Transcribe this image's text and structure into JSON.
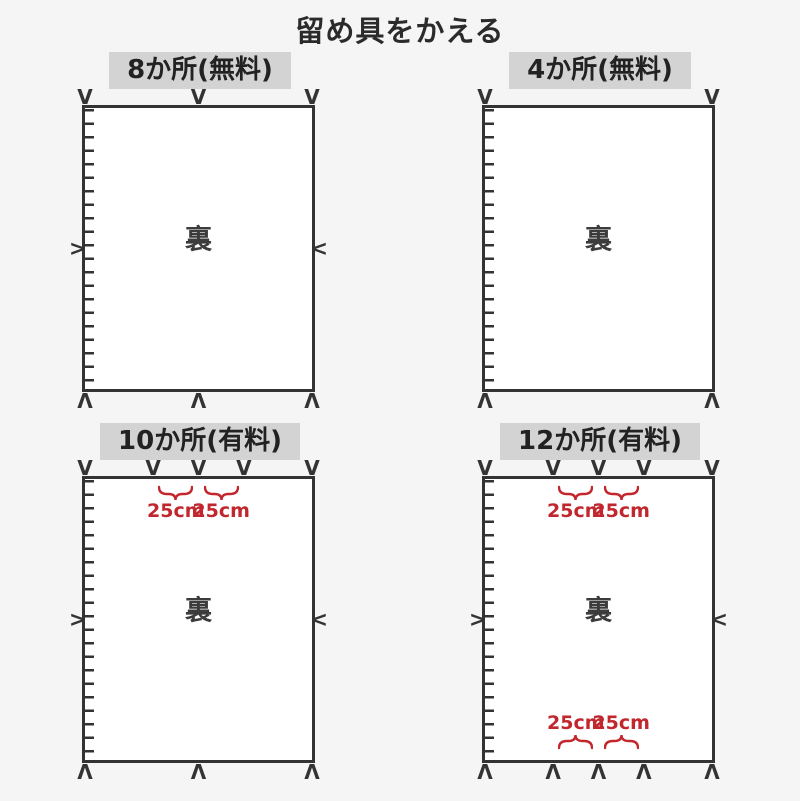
{
  "page": {
    "title": "留め具をかえる",
    "bg": "#f5f5f5"
  },
  "colors": {
    "ink": "#333333",
    "red": "#c1272d",
    "label_bg": "#d3d3d3",
    "rect_bg": "#ffffff"
  },
  "glyphs": {
    "fastener_down": "V",
    "fastener_up": "Λ",
    "fastener_right": ">",
    "fastener_left": "<"
  },
  "panels": [
    {
      "id": "spots-8-free",
      "label": "8か所(無料)",
      "center_label": "裏",
      "top_marks_pct": [
        0,
        50,
        100
      ],
      "bottom_marks_pct": [
        0,
        50,
        100
      ],
      "side_marks": true,
      "annotations": []
    },
    {
      "id": "spots-4-free",
      "label": "4か所(無料)",
      "center_label": "裏",
      "top_marks_pct": [
        0,
        100
      ],
      "bottom_marks_pct": [
        0,
        100
      ],
      "side_marks": false,
      "annotations": []
    },
    {
      "id": "spots-10-paid",
      "label": "10か所(有料)",
      "center_label": "裏",
      "top_marks_pct": [
        0,
        30,
        50,
        70,
        100
      ],
      "bottom_marks_pct": [
        0,
        50,
        100
      ],
      "side_marks": true,
      "annotations": [
        {
          "edge": "top",
          "from_pct": 30,
          "to_pct": 50,
          "label": "25cm"
        },
        {
          "edge": "top",
          "from_pct": 50,
          "to_pct": 70,
          "label": "25cm"
        }
      ]
    },
    {
      "id": "spots-12-paid",
      "label": "12か所(有料)",
      "center_label": "裏",
      "top_marks_pct": [
        0,
        30,
        50,
        70,
        100
      ],
      "bottom_marks_pct": [
        0,
        30,
        50,
        70,
        100
      ],
      "side_marks": true,
      "annotations": [
        {
          "edge": "top",
          "from_pct": 30,
          "to_pct": 50,
          "label": "25cm"
        },
        {
          "edge": "top",
          "from_pct": 50,
          "to_pct": 70,
          "label": "25cm"
        },
        {
          "edge": "bottom",
          "from_pct": 30,
          "to_pct": 50,
          "label": "25cm"
        },
        {
          "edge": "bottom",
          "from_pct": 50,
          "to_pct": 70,
          "label": "25cm"
        }
      ]
    }
  ]
}
